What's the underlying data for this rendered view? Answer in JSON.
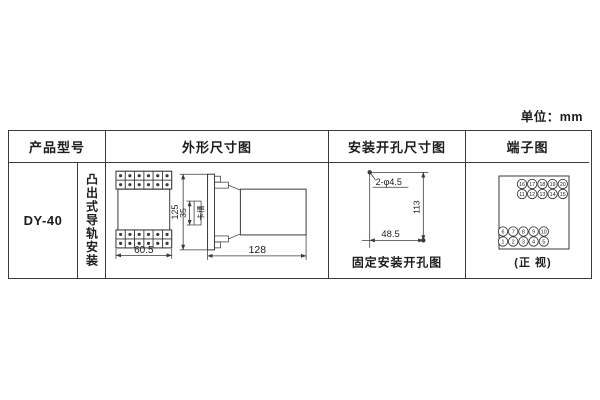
{
  "unit_label": "单位：mm",
  "table": {
    "headers": {
      "product_model": "产品型号",
      "outline": "外形尺寸图",
      "mounting": "安装开孔尺寸图",
      "terminal": "端子图"
    },
    "product": {
      "model": "DY-40",
      "mounting_type": "凸出式导轨安装"
    }
  },
  "outline_drawing": {
    "front_width": "60.5",
    "height": "125",
    "rail_width": "35",
    "rail_label": "卡槽",
    "depth": "128"
  },
  "mounting_drawing": {
    "hole_spec": "2-φ4.5",
    "vertical_spacing": "113",
    "horizontal_spacing": "48.5",
    "caption": "固定安装开孔图"
  },
  "terminal_diagram": {
    "top_rows": [
      [
        "16",
        "17",
        "18",
        "19",
        "20"
      ],
      [
        "11",
        "12",
        "13",
        "14",
        "15"
      ]
    ],
    "bottom_rows": [
      [
        "6",
        "7",
        "8",
        "9",
        "10"
      ],
      [
        "1",
        "2",
        "3",
        "4",
        "5"
      ]
    ],
    "caption": "(正 视)"
  }
}
